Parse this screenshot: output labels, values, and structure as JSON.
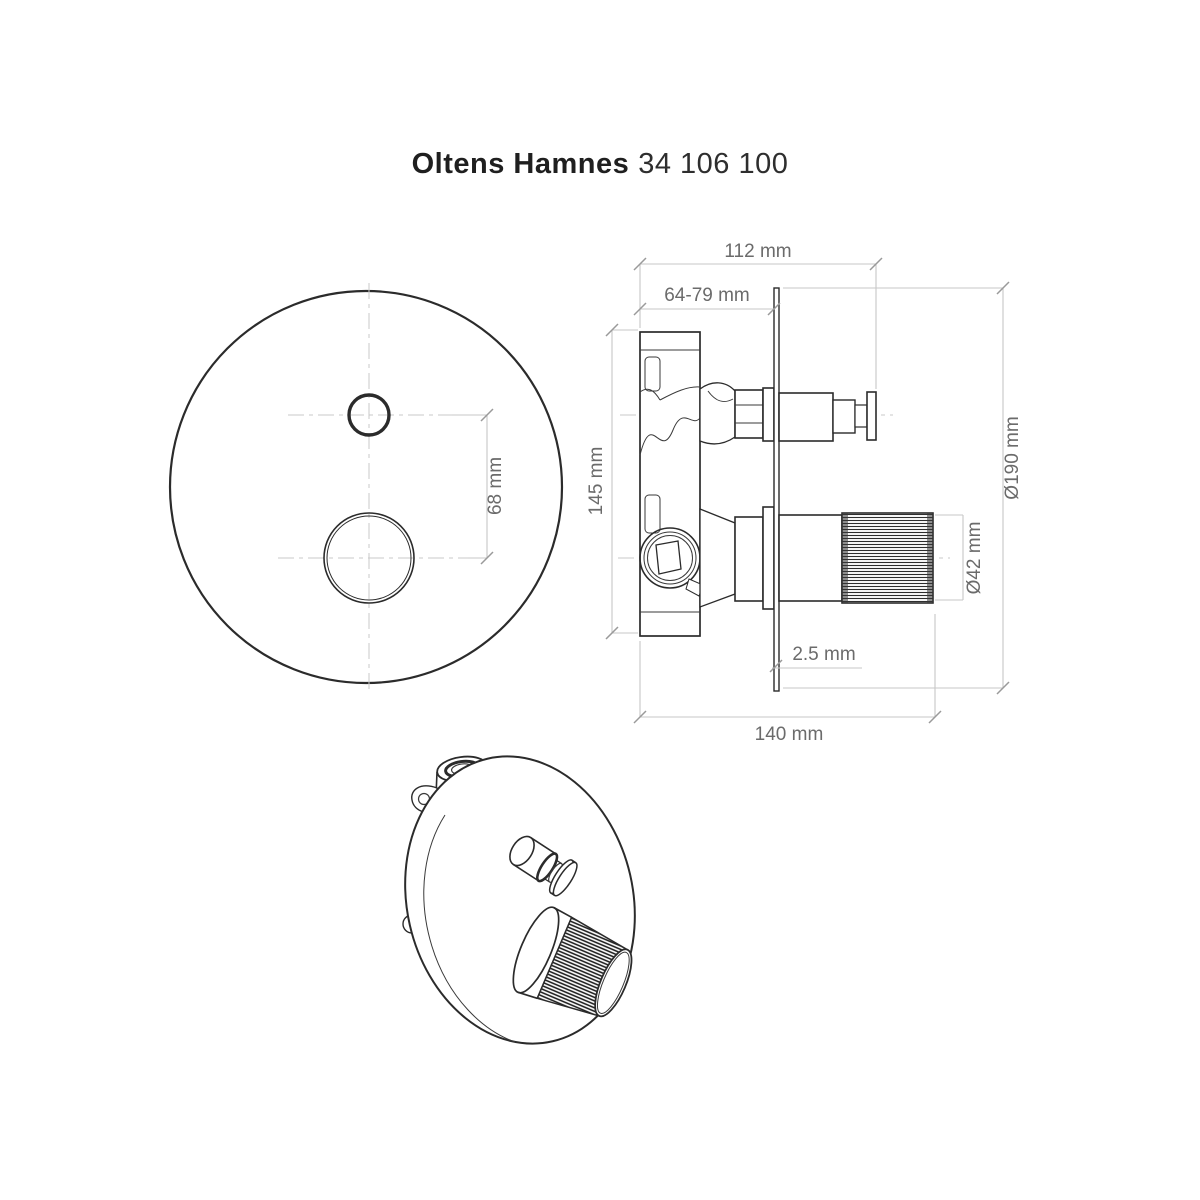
{
  "title": {
    "brand": "Oltens Hamnes",
    "code": "34 106 100"
  },
  "colors": {
    "background": "#ffffff",
    "drawing_line": "#2b2b2b",
    "dimension_line": "#c7c7c7",
    "dimension_text": "#6b6b6b",
    "title_text": "#1f1f1f"
  },
  "front_view": {
    "dim_knob_spacing": "68 mm"
  },
  "side_view": {
    "dim_depth_total": "112 mm",
    "dim_depth_adjustable": "64-79 mm",
    "dim_body_height": "145 mm",
    "dim_plate_diameter": "Ø190 mm",
    "dim_knob_diameter": "Ø42 mm",
    "dim_plate_thickness": "2.5 mm",
    "dim_width_overall": "140 mm"
  }
}
